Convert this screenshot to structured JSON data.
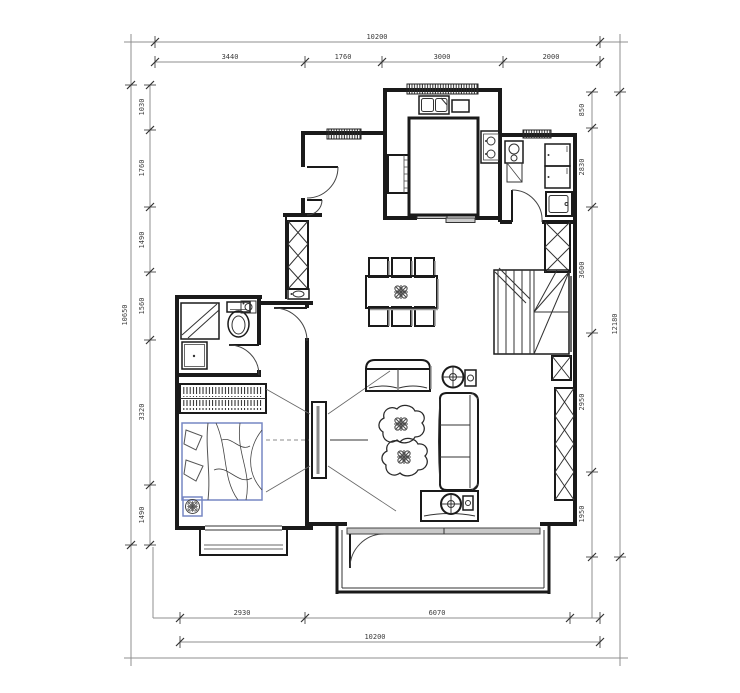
{
  "drawing": {
    "type": "architectural-floor-plan",
    "style": "CAD line drawing, black on white"
  },
  "dimensions": {
    "top": {
      "overall": "10200",
      "segments": [
        "3440",
        "1760",
        "3000",
        "2000"
      ]
    },
    "bottom": {
      "overall": "10200",
      "segments": [
        "2930",
        "6070"
      ]
    },
    "left": {
      "overall": "10650",
      "segments": [
        "1030",
        "1760",
        "1490",
        "1560",
        "3320",
        "1490"
      ]
    },
    "right": {
      "overall": "12180",
      "segments": [
        "850",
        "2830",
        "3600",
        "2950",
        "1950"
      ]
    }
  },
  "colors": {
    "background": "#ffffff",
    "wall": "#1a1a1a",
    "dim_line": "#8f8f8f",
    "dim_text": "#3b3b3b",
    "accent_blue": "#7787c3",
    "shade_gray": "#9a9a9a"
  },
  "furniture": [
    "kitchen-sink",
    "cutting-board",
    "kitchen-island",
    "cooktop",
    "refrigerator",
    "washing-machine",
    "utility-cabinet",
    "utility-sink",
    "entry-door",
    "shoe-cabinet",
    "hall-basin",
    "dining-table",
    "dining-chairs",
    "flower-centerpiece",
    "staircase",
    "structural-columns",
    "shower",
    "toilet",
    "corner-basin",
    "vanity",
    "wardrobe",
    "double-bed",
    "potted-plant",
    "tv-panel",
    "loveseat",
    "sofa",
    "coffee-tables",
    "side-tables",
    "balcony-sliding-door",
    "bay-window"
  ]
}
